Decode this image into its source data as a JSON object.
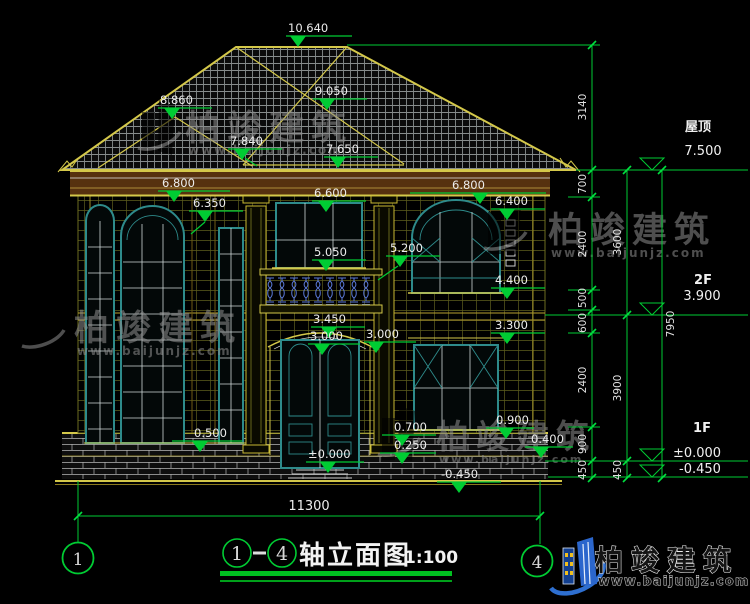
{
  "drawing": {
    "title": {
      "axis_start": "1",
      "axis_end": "4",
      "name": "轴立面图",
      "scale": "1:100"
    },
    "axis_bubbles": {
      "left": "1",
      "right": "4"
    },
    "overall_width_dim": "11300",
    "levels": {
      "roof": {
        "label": "屋顶",
        "value": "7.500"
      },
      "f2": {
        "label": "2F",
        "value": "3.900"
      },
      "f1": {
        "label": "1F",
        "value": "±0.000",
        "ground": "-0.450"
      }
    },
    "chains": {
      "inner": [
        "3140",
        "700",
        "2400",
        "500",
        "600",
        "2400",
        "900",
        "450"
      ],
      "middle": [
        "3600",
        "3900",
        "450"
      ],
      "outer": [
        "7950"
      ]
    },
    "spots": {
      "ridge": "10.640",
      "porch_peak": "9.050",
      "left_peak": "8.860",
      "valley": "7.840",
      "porch_eave": "7.650",
      "eave_left": "6.800",
      "arch_spring": "6.350",
      "center_head": "6.600",
      "eave_right": "6.800",
      "right_head": "6.400",
      "pilaster_top": "5.200",
      "balcony_rail": "5.050",
      "right_sill": "4.400",
      "door_arch": "3.450",
      "door_head_left": "3.000",
      "door_head_right": "3.000",
      "f1_head_right": "3.300",
      "left_sill": "0.500",
      "porch_rail": "0.700",
      "porch_step": "0.250",
      "f1_sill_right": "0.900",
      "base_right": "0.400",
      "floor": "±0.000",
      "ground": "-0.450"
    }
  },
  "branding": {
    "logo": {
      "name": "柏竣建筑",
      "url": "www.baijunjz.com"
    },
    "watermark": {
      "name": "柏竣建筑",
      "url": "www.baijunjz.com"
    }
  },
  "colors": {
    "background": "#000000",
    "dimension_green": "#00cc33",
    "roof_yellow": "#d4c84a",
    "window_teal": "#2e8b8b",
    "baluster_blue": "#5b79d8",
    "logo_blue": "#2b66cc",
    "eave_brown": "#56310f",
    "text": "#ececec"
  }
}
